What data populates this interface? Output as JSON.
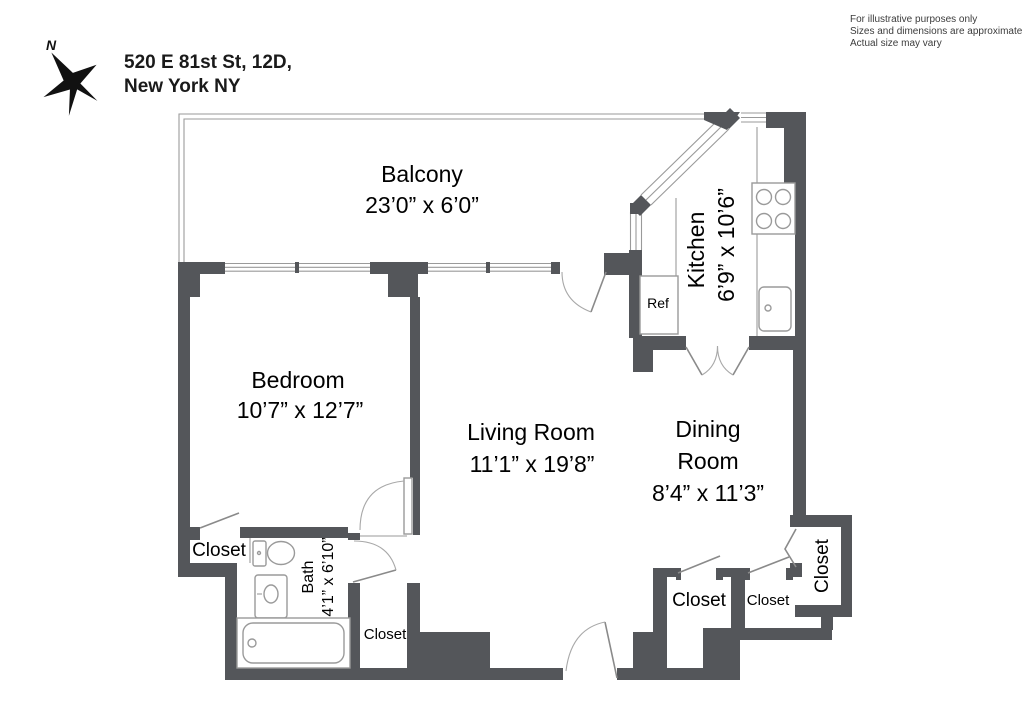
{
  "header": {
    "address_line1": "520 E 81st St, 12D,",
    "address_line2": "New York NY",
    "compass_label": "N"
  },
  "disclaimer": {
    "line1": "For illustrative purposes only",
    "line2": "Sizes and dimensions are approximate",
    "line3": "Actual size may vary"
  },
  "rooms": {
    "balcony": {
      "name": "Balcony",
      "dims": "23’0” x 6’0”"
    },
    "kitchen": {
      "name": "Kitchen",
      "dims": "6’9” x 10’6”"
    },
    "bedroom": {
      "name": "Bedroom",
      "dims": "10’7” x 12’7”"
    },
    "living_room": {
      "name": "Living Room",
      "dims": "11’1” x 19’8”"
    },
    "dining_room": {
      "name_line1": "Dining",
      "name_line2": "Room",
      "dims": "8’4” x 11’3”"
    },
    "bath": {
      "name": "Bath",
      "dims": "4’1” x 6’10”"
    }
  },
  "labels": {
    "ref": "Ref",
    "bedroom_closet": "Closet",
    "hall_closet": "Closet",
    "dining_closet_large": "Closet",
    "dining_closet_small": "Closet",
    "entry_closet": "Closet"
  },
  "colors": {
    "wall": "#54565a",
    "line": "#9a9a9a",
    "text": "#000000"
  }
}
